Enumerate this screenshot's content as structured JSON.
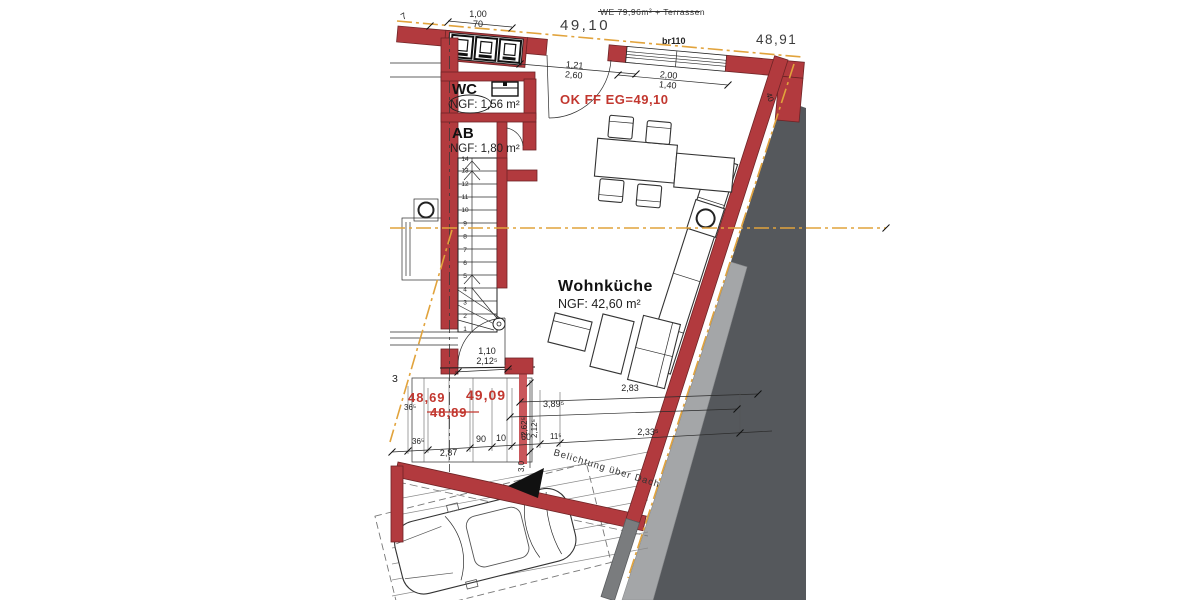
{
  "title": "floor-plan-erdgeschoss",
  "colors": {
    "wall_red": "#b23a3e",
    "wall_red_light": "#c9575b",
    "annotation_red": "#c2372f",
    "survey_orange": "#e1a33c",
    "roof_dark": "#55585c",
    "roof_light": "#a4a6a8",
    "line_black": "#2b2b2b"
  },
  "header": {
    "strike_note": "WE 79,96m² + Terrassen",
    "level_top": "49,10",
    "level_top_right": "48,91",
    "lintel": "br110"
  },
  "rooms": {
    "wc": {
      "name": "WC",
      "area": "NGF: 1,56 m²"
    },
    "ab": {
      "name": "AB",
      "area": "NGF: 1,80 m²"
    },
    "wohnkueche": {
      "name": "Wohnküche",
      "area": "NGF:  42,60 m²"
    }
  },
  "levels": {
    "ok_ff": "OK FF EG=49,10",
    "terrace_a": "48,69",
    "terrace_b": "49,09",
    "terrace_old": "48,89"
  },
  "notes": {
    "belichtung": "Belichtung über Dach"
  },
  "dims": {
    "d100": "1,00",
    "d70": "70",
    "d7": "7",
    "d3": "3",
    "d121": "1,21",
    "d260": "2,60",
    "d200": "2,00",
    "d140": "1,40",
    "d40": "40",
    "d110": "1,10",
    "d2125": "2,12⁵",
    "d283": "2,83",
    "d3895": "3,89⁵",
    "d365a": "36⁵",
    "d365b": "36⁵",
    "d287": "2,87",
    "d90": "90",
    "d10": "10",
    "d60": "60",
    "d115": "11⁵",
    "d2335": "2,33⁵",
    "d2625": "2,62⁵",
    "d2125v": "2,12⁵",
    "d30": "3,0"
  },
  "stairs": {
    "numbers": [
      "1",
      "2",
      "3",
      "4",
      "5",
      "6",
      "7",
      "8",
      "9",
      "10",
      "11",
      "12",
      "13",
      "14"
    ]
  }
}
